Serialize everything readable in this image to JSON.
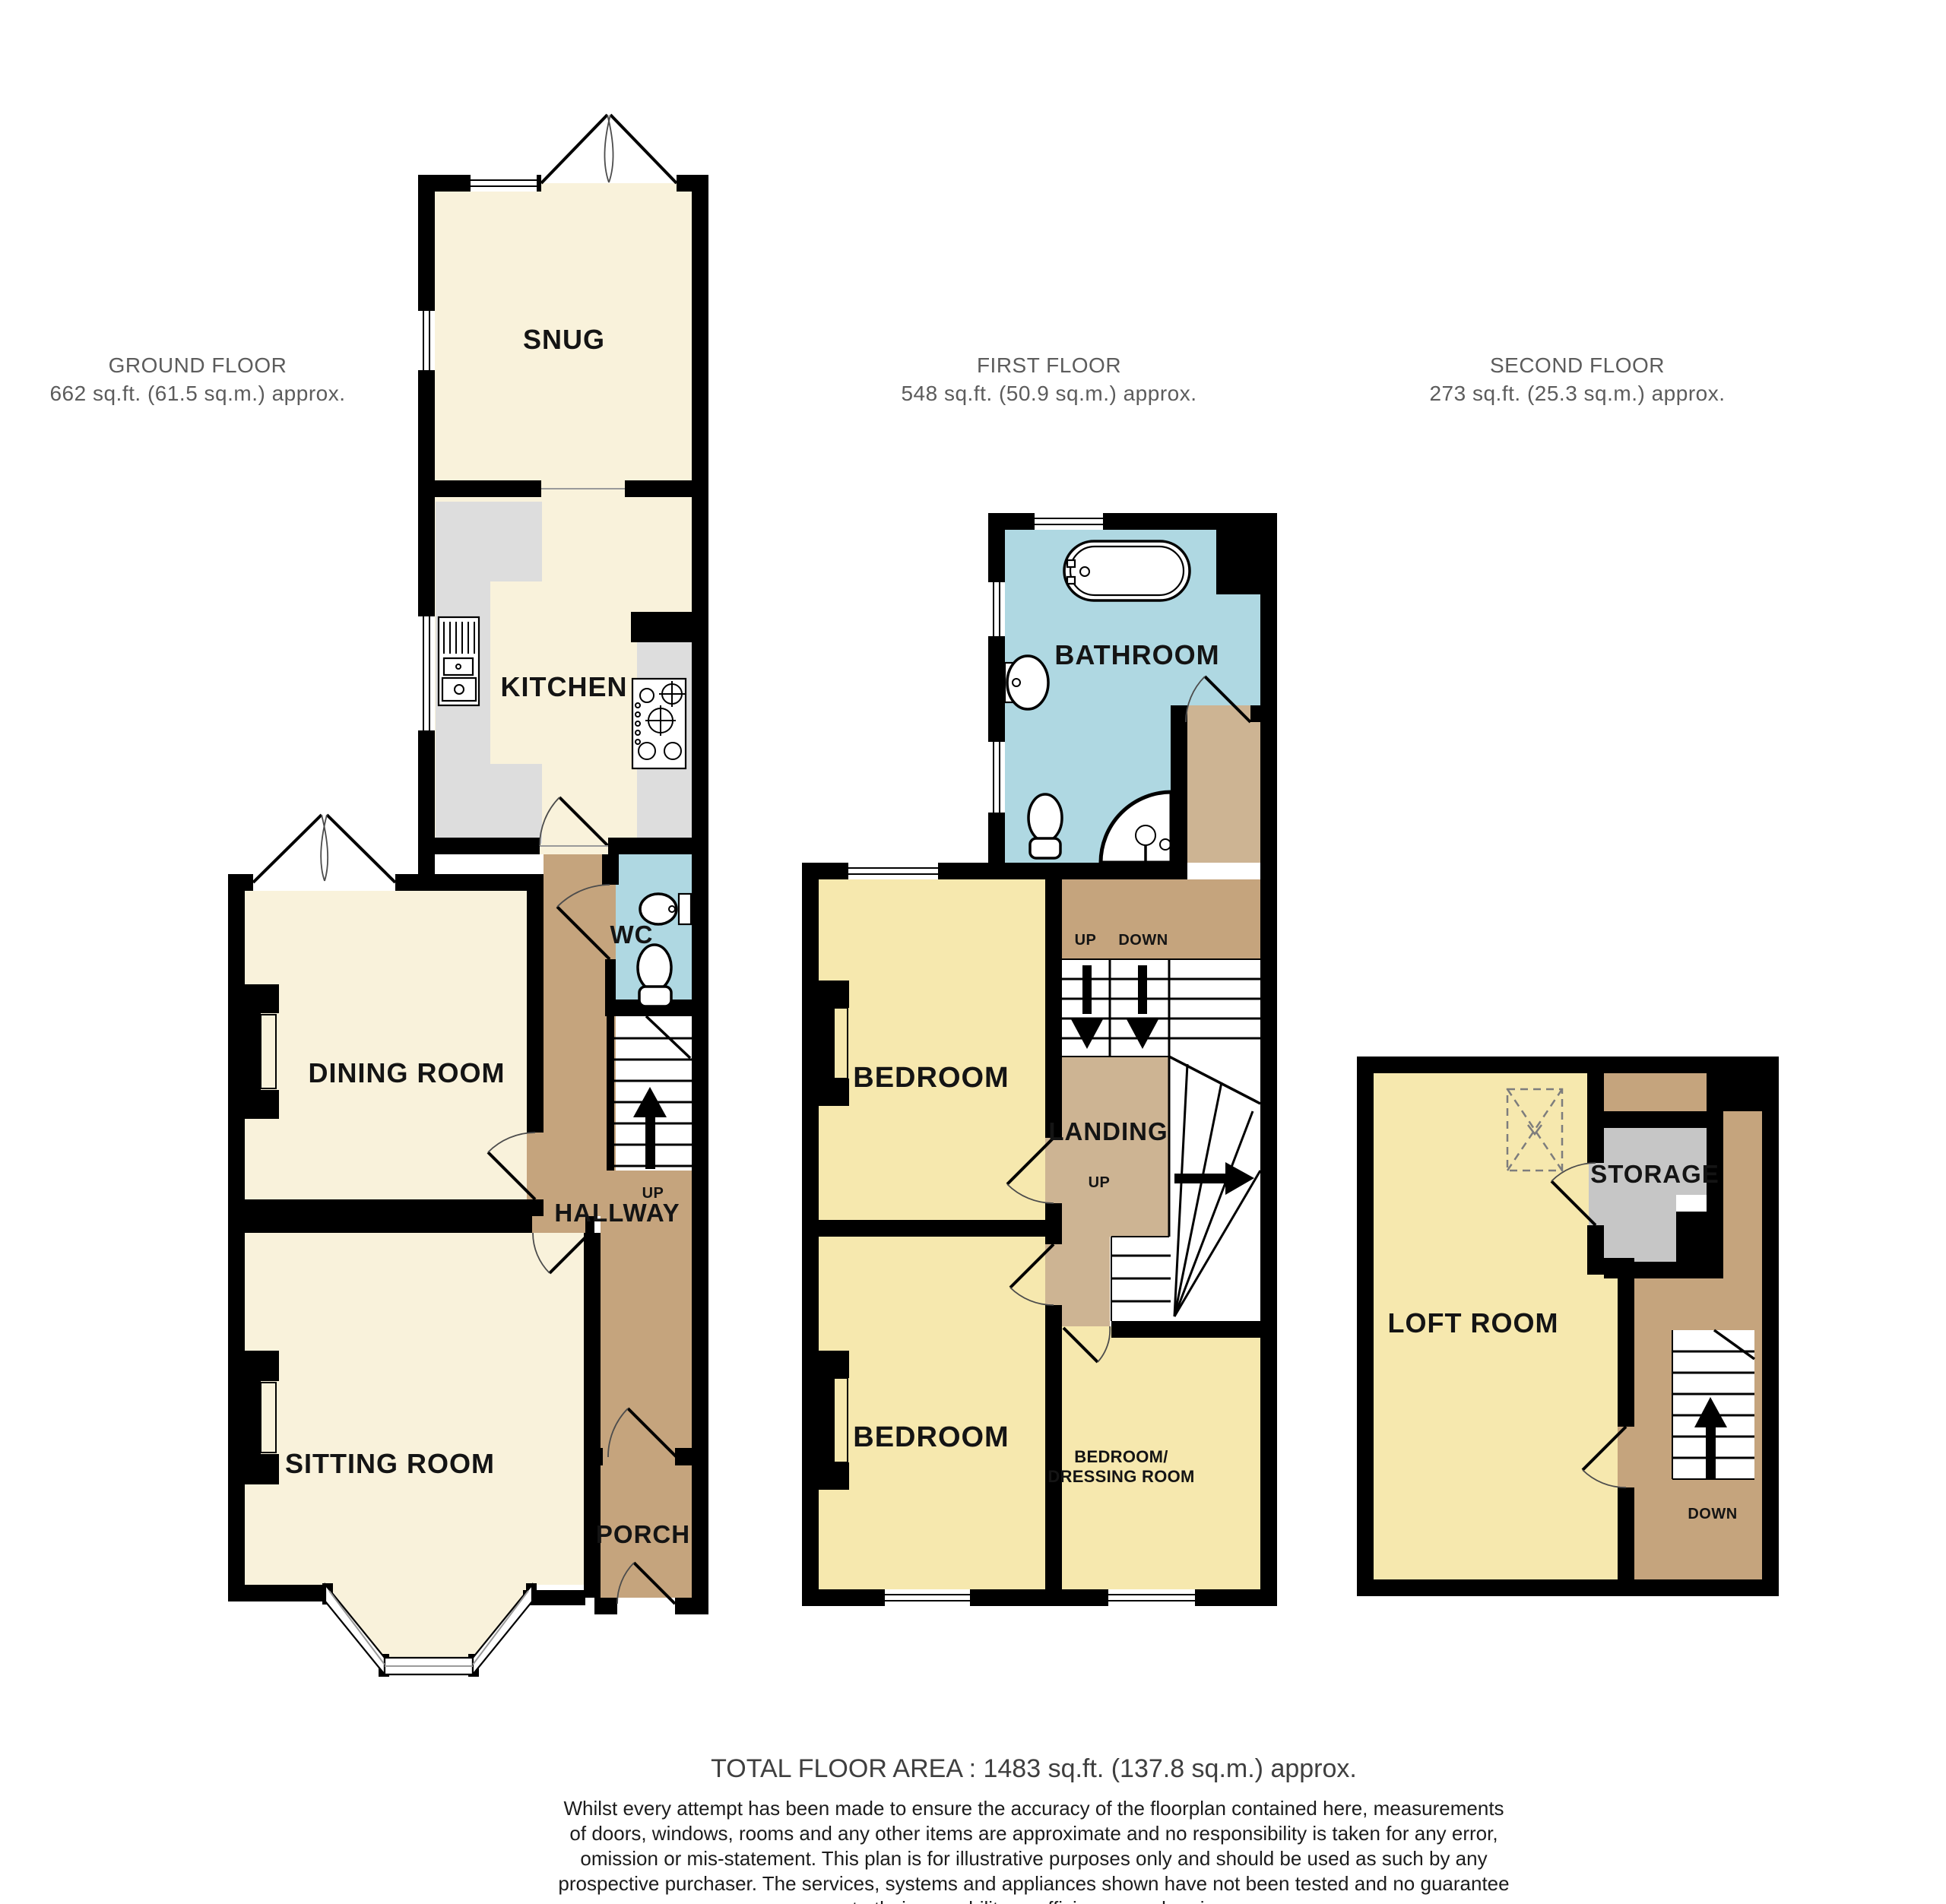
{
  "document_type": "floorplan",
  "floors": [
    {
      "id": "ground",
      "title": "GROUND FLOOR",
      "area": "662 sq.ft. (61.5 sq.m.) approx.",
      "labels": {
        "snug": "SNUG",
        "kitchen": "KITCHEN",
        "wc": "WC",
        "dining": "DINING ROOM",
        "up": "UP",
        "hallway": "HALLWAY",
        "sitting": "SITTING ROOM",
        "porch": "PORCH"
      }
    },
    {
      "id": "first",
      "title": "FIRST FLOOR",
      "area": "548 sq.ft. (50.9 sq.m.) approx.",
      "labels": {
        "bathroom": "BATHROOM",
        "bedroom_front": "BEDROOM",
        "up_top": "UP",
        "down_top": "DOWN",
        "landing": "LANDING",
        "up_mid": "UP",
        "bedroom_back": "BEDROOM",
        "dressing_line1": "BEDROOM/",
        "dressing_line2": "DRESSING ROOM"
      }
    },
    {
      "id": "second",
      "title": "SECOND FLOOR",
      "area": "273 sq.ft. (25.3 sq.m.) approx.",
      "labels": {
        "loft": "LOFT ROOM",
        "storage": "STORAGE",
        "down": "DOWN"
      }
    }
  ],
  "footer": {
    "total": "TOTAL FLOOR AREA : 1483 sq.ft. (137.8 sq.m.) approx.",
    "lines": [
      "Whilst every attempt has been made to ensure the accuracy of the floorplan contained here, measurements",
      "of doors, windows, rooms and any other items are approximate and no responsibility is taken for any error,",
      "omission or mis-statement. This plan is for illustrative purposes only and should be used as such by any",
      "prospective purchaser. The services, systems and appliances shown have not been tested and no guarantee",
      "as to their operability or efficiency can be given."
    ],
    "credit": "Made with Metropix ©2026"
  },
  "colors": {
    "cream": "#F9F2DB",
    "yellow": "#F6E8AE",
    "blue": "#AFD8E2",
    "tan": "#C5A47D",
    "tanLight": "#CDB493",
    "storageGray": "#C6C6C6",
    "counterGray": "#DDDDDD",
    "wall": "#000000",
    "headerGray": "#5C5C5C"
  }
}
